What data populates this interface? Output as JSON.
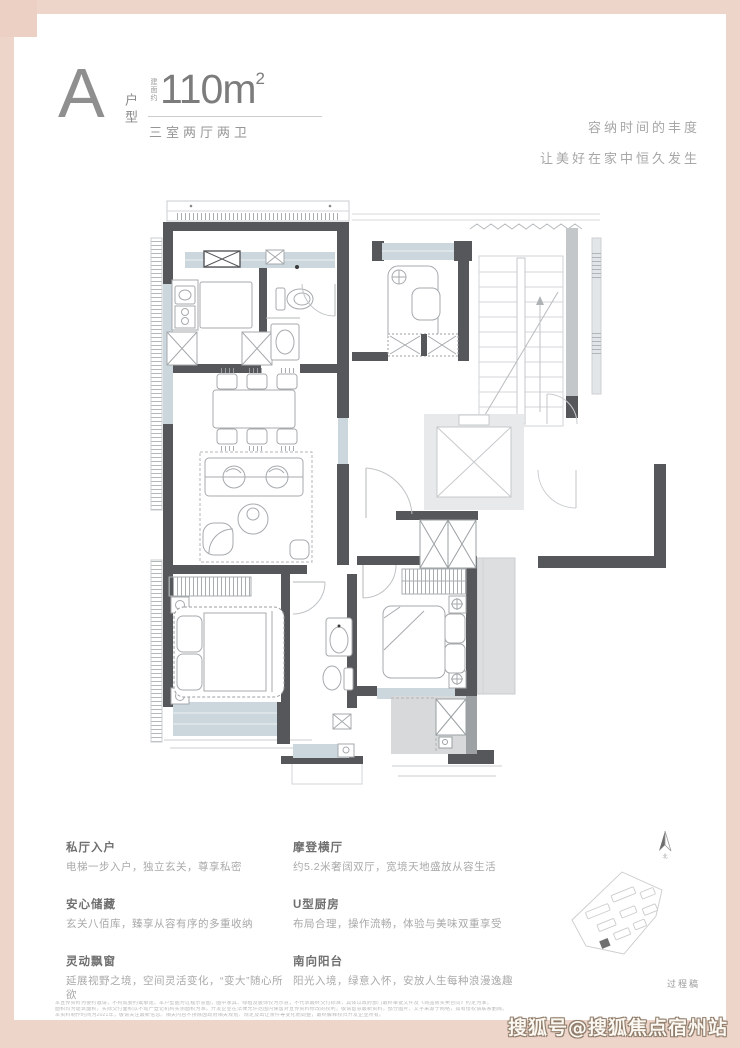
{
  "header": {
    "type_letter": "A",
    "type_label": "户型",
    "area_prefix": "建面约",
    "area_number": "110m",
    "area_sup": "2",
    "rooms_label": "三室两厅两卫"
  },
  "tagline": {
    "line1": "容纳时间的丰度",
    "line2": "让美好在家中恒久发生"
  },
  "features": {
    "left": [
      {
        "title": "私厅入户",
        "desc": "电梯一步入户，独立玄关，尊享私密"
      },
      {
        "title": "安心储藏",
        "desc": "玄关八佰库，臻享从容有序的多重收纳"
      },
      {
        "title": "灵动飘窗",
        "desc": "延展视野之境，空间灵活变化，“变大”随心所欲"
      }
    ],
    "right": [
      {
        "title": "摩登横厅",
        "desc": "约5.2米奢阔双厅，宽境天地盛放从容生活"
      },
      {
        "title": "U型厨房",
        "desc": "布局合理，操作流畅，体验与美味双重享受"
      },
      {
        "title": "南向阳台",
        "desc": "阳光入境，绿意入怀，安放人生每种浪漫逸趣"
      }
    ]
  },
  "compass": {
    "north_label": "北"
  },
  "footer": {
    "draft_label": "过程稿",
    "disclaimer": [
      "本宣传资料为要约邀请，不构成要约或承诺。本户型图为过程示意图，图中家具、绿植及装饰仅为示意，不代表最终交付标准，具体以政府部门最终审批文件及《商品房买卖合同》约定为准。",
      "面积均为建筑面积，实际交付面积以不动产登记机构实测面积为准。开发企业在法律允许范围内保留对宣传资料修改的权利，敬请留意最新资料。部分图片、文字来源于网络，如有侵权请联系删除。",
      "本资料制作时间为2021年，敬请关注最新信息。相关内容不排除因政府相关规划、规定及出让条件等变化而调整，最终解释权归开发企业所有。"
    ]
  },
  "watermark": {
    "text": "搜狐号@搜狐焦点宿州站"
  },
  "colors": {
    "frame_pink": "#eed5ca",
    "wall_dark": "#56575b",
    "window_fill": "#ccd6dd",
    "common_gray": "#dcdedf",
    "title_gray": "#6f6f6f",
    "desc_gray": "#a9a9a9"
  },
  "icons": {
    "north_arrow": "north-arrow-icon",
    "site_plan": "siteplan-map"
  }
}
